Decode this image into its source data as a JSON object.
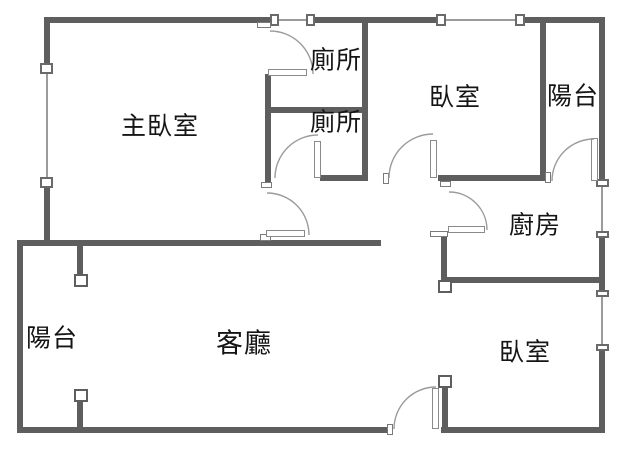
{
  "plan": {
    "background": "#ffffff",
    "wall_color": "#5e5e5e",
    "line_color": "#9b9b9b",
    "text_color": "#151515",
    "rooms": [
      {
        "id": "master-bedroom",
        "label": "主臥室"
      },
      {
        "id": "toilet-upper",
        "label": "廁所"
      },
      {
        "id": "toilet-lower",
        "label": "廁所"
      },
      {
        "id": "bedroom-upper",
        "label": "臥室"
      },
      {
        "id": "balcony-upper",
        "label": "陽台"
      },
      {
        "id": "kitchen",
        "label": "廚房"
      },
      {
        "id": "living-room",
        "label": "客廳"
      },
      {
        "id": "balcony-lower",
        "label": "陽台"
      },
      {
        "id": "bedroom-lower",
        "label": "臥室"
      }
    ],
    "features": {
      "doors": [
        "toilet-upper-door",
        "master-bedroom-door",
        "toilet-lower-door",
        "bedroom-upper-door",
        "kitchen-door",
        "balcony-upper-door",
        "entrance-door"
      ],
      "windows": [
        "master-bedroom-west-window",
        "toilet-upper-north-window",
        "bedroom-upper-north-window",
        "kitchen-east-window",
        "bedroom-lower-east-window"
      ]
    }
  }
}
